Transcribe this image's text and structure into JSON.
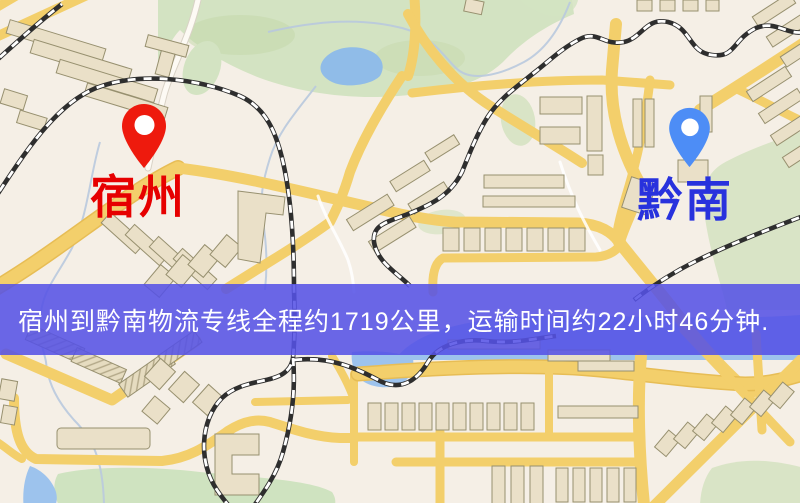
{
  "map": {
    "banner": {
      "text": "宿州到黔南物流专线全程约1719公里，运输时间约22小时46分钟.",
      "background_color": "#5552e6",
      "text_color": "#ffffff"
    },
    "markers": {
      "origin": {
        "name": "宿州",
        "pin_color": "#ee1a0d",
        "label_color": "#e60000"
      },
      "destination": {
        "name": "黔南",
        "pin_color": "#4d8df6",
        "label_color": "#2832dd"
      }
    },
    "theme": {
      "background": "#f5efe6",
      "road": "#f3cf6b",
      "road_casing": "#e7bd55",
      "minor_road": "#fdfaf4",
      "railway": "#2e2e2e",
      "building": "#eae0c8",
      "building_outline": "#97906f",
      "park_green": "#d3e3c2",
      "zone_green": "#d9e4c6",
      "water": "#9dc3ed",
      "stream": "#b9c9de"
    }
  }
}
